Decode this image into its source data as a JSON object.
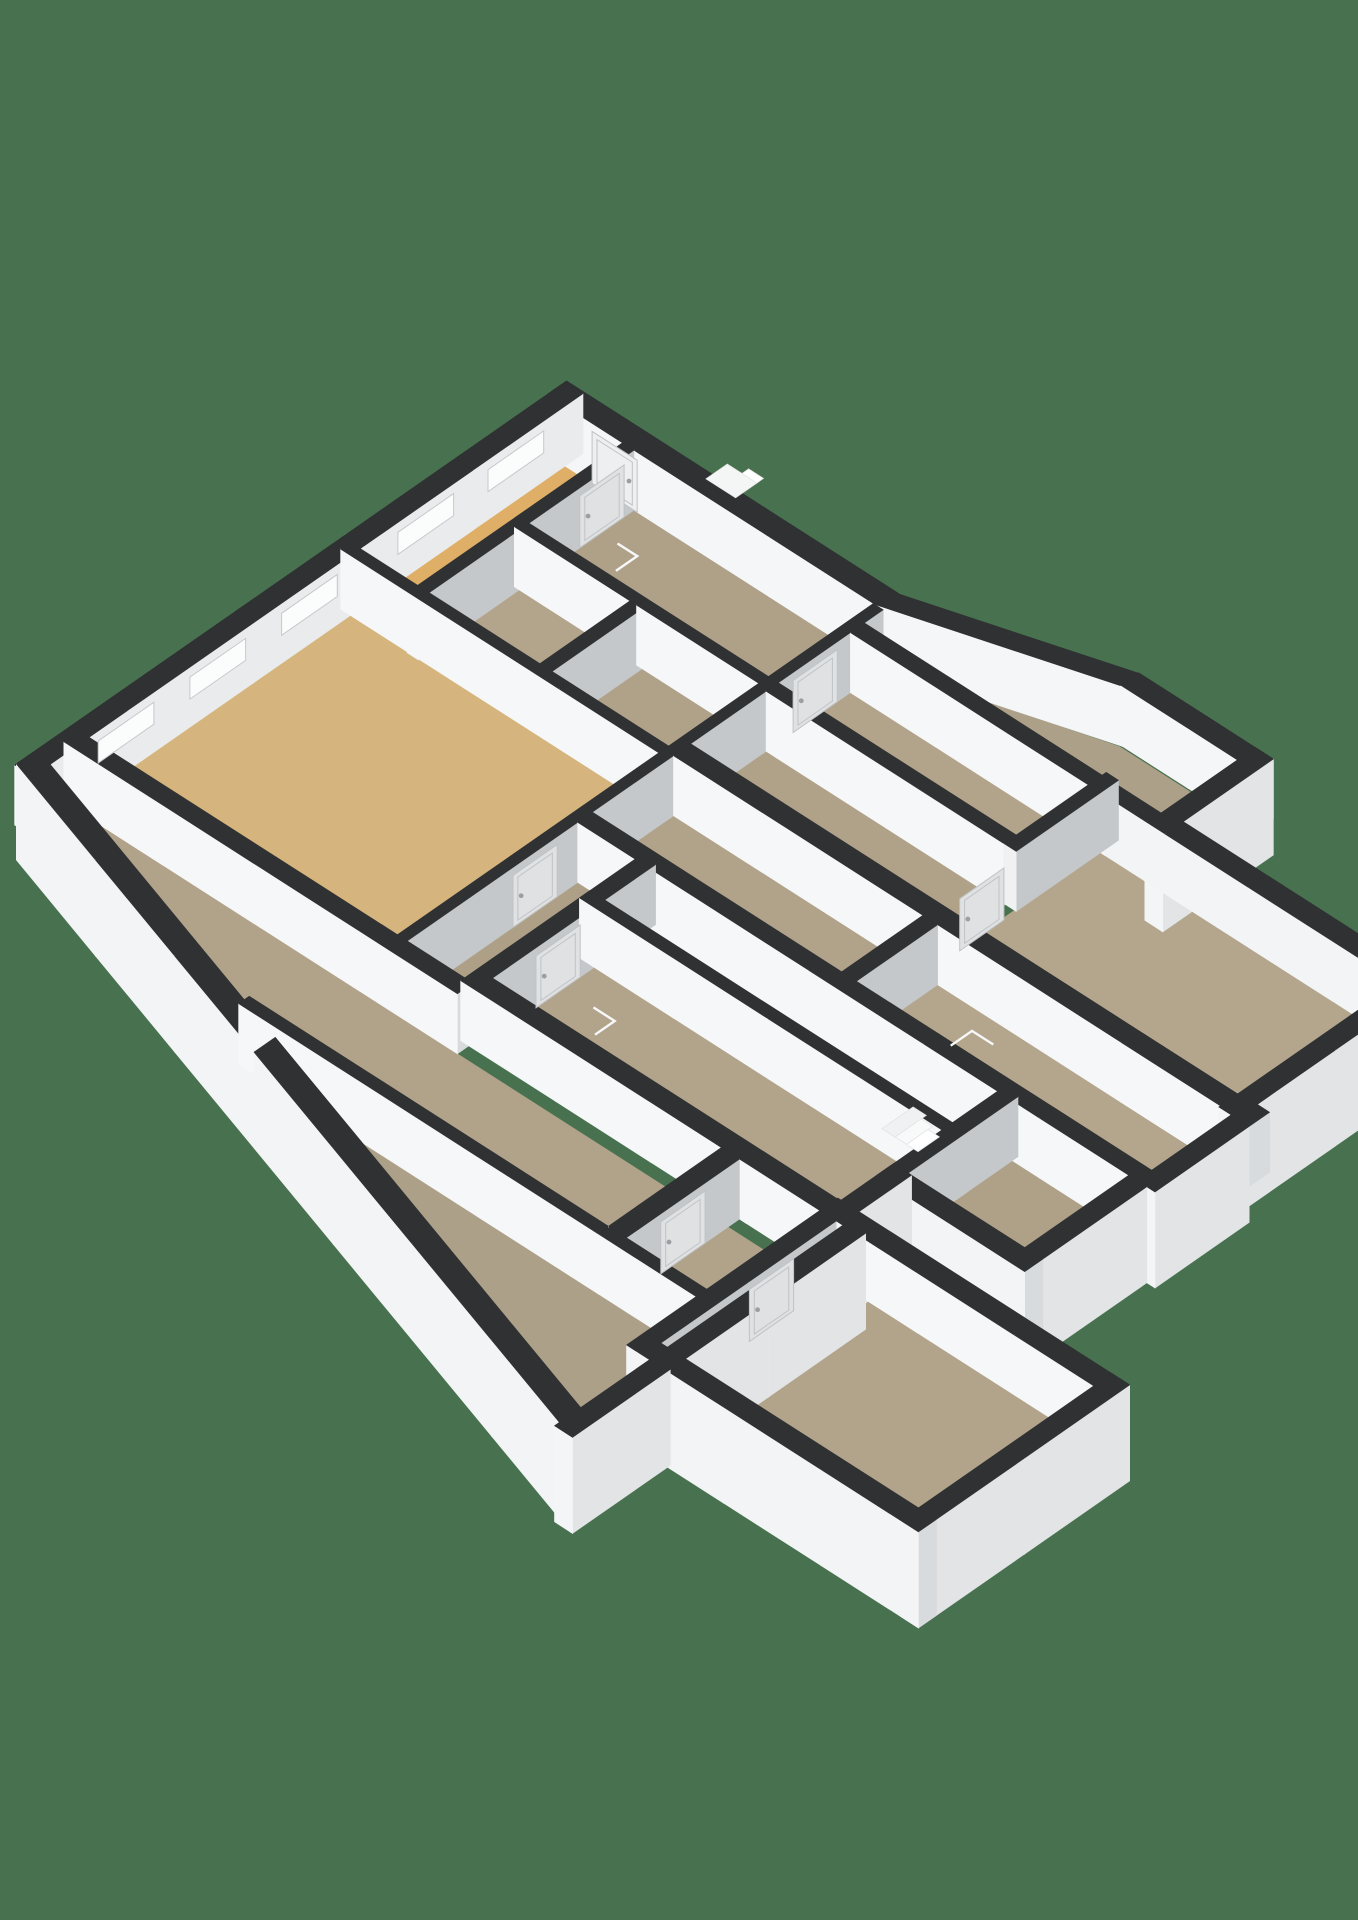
{
  "canvas": {
    "width": 1358,
    "height": 1920,
    "background": "#48714F"
  },
  "projection": {
    "ox": 565,
    "oy": 442,
    "exx": 0.82,
    "exy": 0.525,
    "eyx": -0.819,
    "eyy": 0.57,
    "wall_height": 60,
    "skirt_depth": 36,
    "chunk": 150
  },
  "palette": {
    "wall_top": "#2F3133",
    "face_white": "#F6F7F8",
    "face_gray": "#C4C8CB",
    "face_nw_inner": "#E9EBEC",
    "face_ext_east": "#E2E4E6",
    "face_ext_south": "#F3F4F5",
    "face_cap_gray": "#D8DADC",
    "skirt": "#C9CCCE",
    "floor_gold_big": "#D5B57D",
    "floor_gold_corridor": "#E2AC62",
    "floor_gold_hall": "#DFAF68",
    "floor_taupe": "#B1A28A",
    "window_fill": "#FBFCFC",
    "window_stroke": "#C6C9CB",
    "door_fill": "#DFE1E3",
    "door_stroke": "#C0C3C6",
    "door_fill_light": "#EDEFF0",
    "marker_white": "#F7F8F8"
  },
  "wall_types": {
    "extNW": {
      "fu": "#E9EBEC",
      "fv": "#F6F7F8",
      "skirt": false
    },
    "extTop": {
      "fu": "#DFE2E4",
      "fv": "#F5F6F7",
      "skirt": false
    },
    "extE": {
      "fu": "#E2E4E6",
      "fv": "#F4F5F6",
      "skirt": true
    },
    "extS": {
      "fu": "#D8DBDD",
      "fv": "#F3F4F5",
      "skirt": true
    },
    "extS_ns": {
      "fu": "#D8DBDD",
      "fv": "#F3F4F5",
      "skirt": false
    },
    "int_u": {
      "fu": "#D8DADC",
      "fv": "#F6F7F8",
      "skirt": false
    },
    "int_v": {
      "fu": "#C4C8CB",
      "fv": "#EFF1F2",
      "skirt": false
    }
  },
  "floors": [
    {
      "name": "floor-hall-nw",
      "color": "#DFAF68",
      "rect": [
        22,
        22,
        92,
        285
      ]
    },
    {
      "name": "floor-room-top",
      "color": "#AFA088",
      "rect": [
        100,
        22,
        398,
        150
      ]
    },
    {
      "name": "floor-room-mid-a",
      "color": "#B3A48C",
      "rect": [
        100,
        162,
        241,
        272
      ]
    },
    {
      "name": "floor-room-mid-b",
      "color": "#B0A189",
      "rect": [
        250,
        162,
        398,
        272
      ]
    },
    {
      "name": "floor-room-big-gold",
      "color": "#D5B57D",
      "rect": [
        22,
        284,
        398,
        603
      ]
    },
    {
      "name": "floor-room-ne",
      "color": "#ADA089",
      "pts": [
        [
          410,
          18
        ],
        [
          630,
          -46
        ],
        [
          772,
          -46
        ],
        [
          772,
          47
        ],
        [
          410,
          47
        ]
      ]
    },
    {
      "name": "floor-room-ne-low",
      "color": "#B2A38B",
      "rect": [
        410,
        60,
        702,
        152
      ]
    },
    {
      "name": "floor-room-right-big",
      "color": "#B4A58D",
      "rect": [
        713,
        60,
        1077,
        257
      ]
    },
    {
      "name": "floor-room-center",
      "color": "#B0A189",
      "rect": [
        410,
        165,
        702,
        257
      ]
    },
    {
      "name": "floor-room-d1",
      "color": "#B1A28A",
      "rect": [
        410,
        278,
        714,
        377
      ]
    },
    {
      "name": "floor-room-d2",
      "color": "#B4A58D",
      "rect": [
        732,
        278,
        1092,
        377
      ]
    },
    {
      "name": "floor-room-d3",
      "color": "#AEA087",
      "rect": [
        410,
        388,
        480,
        587
      ]
    },
    {
      "name": "floor-corridor-gold",
      "color": "#E2AC62",
      "rect": [
        498,
        388,
        922,
        450
      ]
    },
    {
      "name": "floor-room-f1",
      "color": "#B2A38B",
      "rect": [
        498,
        463,
        922,
        587
      ]
    },
    {
      "name": "floor-room-f2",
      "color": "#AFA088",
      "rect": [
        940,
        395,
        1082,
        522
      ]
    },
    {
      "name": "floor-strip-s1",
      "color": "#B1A28A",
      "pts": [
        [
          22,
          622
        ],
        [
          946,
          622
        ],
        [
          946,
          746
        ],
        [
          333,
          746
        ],
        [
          22,
          651
        ]
      ]
    },
    {
      "name": "floor-strip-s2",
      "color": "#ADA089",
      "pts": [
        [
          388,
          759
        ],
        [
          946,
          759
        ],
        [
          946,
          920
        ],
        [
          920,
          920
        ]
      ]
    },
    {
      "name": "floor-wing",
      "color": "#B2A38B",
      "rect": [
        938,
        608,
        1252,
        822
      ]
    }
  ],
  "walls": [
    {
      "name": "wall-ext-nw",
      "type": "extNW",
      "rect": [
        0,
        0,
        22,
        672
      ],
      "windows": [
        [
          48,
          116
        ],
        [
          158,
          226
        ],
        [
          300,
          368
        ],
        [
          412,
          480
        ],
        [
          524,
          592
        ]
      ]
    },
    {
      "name": "wall-ext-ne-a",
      "type": "extTop",
      "rect": [
        0,
        -2,
        406,
        22
      ],
      "doors": [
        {
          "face": "v",
          "span": [
            55,
            110
          ],
          "style": "light"
        }
      ]
    },
    {
      "name": "wall-ext-ne-diag",
      "type": "extTop",
      "quad": [
        [
          400,
          0
        ],
        [
          632,
          -70
        ],
        [
          632,
          -48
        ],
        [
          400,
          22
        ]
      ]
    },
    {
      "name": "wall-ext-ne-b",
      "type": "extTop",
      "rect": [
        630,
        -70,
        794,
        -48
      ]
    },
    {
      "name": "wall-ext-ne-east",
      "type": "extE",
      "rect": [
        772,
        -70,
        794,
        65
      ]
    },
    {
      "name": "wall-ne-step-south",
      "type": "extS_ns",
      "rect": [
        720,
        45,
        794,
        62
      ]
    },
    {
      "name": "wall-room-right-north",
      "type": "extS_ns",
      "rect": [
        794,
        40,
        1099,
        62
      ]
    },
    {
      "name": "wall-int-t2-t3",
      "type": "int_u",
      "rect": [
        410,
        45,
        720,
        62
      ]
    },
    {
      "name": "wall-int-divider-ne",
      "type": "int_v",
      "rect": [
        700,
        40,
        715,
        165
      ],
      "doors": [
        {
          "face": "u",
          "span": [
            180,
            234
          ]
        }
      ]
    },
    {
      "name": "wall-ext-right-east",
      "type": "extE",
      "rect": [
        1077,
        40,
        1099,
        280
      ]
    },
    {
      "name": "wall-ext-right-step",
      "type": "extS_ns",
      "rect": [
        1077,
        255,
        1114,
        280
      ]
    },
    {
      "name": "wall-ext-d2-east",
      "type": "extE",
      "rect": [
        1092,
        280,
        1114,
        395
      ]
    },
    {
      "name": "wall-int-row2",
      "type": "int_u",
      "rect": [
        410,
        150,
        702,
        165
      ]
    },
    {
      "name": "wall-int-row3",
      "type": "int_u",
      "rect": [
        410,
        257,
        1092,
        278
      ]
    },
    {
      "name": "wall-spine",
      "type": "int_v",
      "rect": [
        398,
        22,
        410,
        608
      ],
      "doors": [
        {
          "face": "u",
          "span": [
            78,
            132
          ]
        },
        {
          "face": "u",
          "span": [
            420,
            474
          ]
        }
      ]
    },
    {
      "name": "wall-int-d1-d2",
      "type": "int_v",
      "rect": [
        714,
        278,
        732,
        377
      ]
    },
    {
      "name": "wall-int-row4",
      "type": "int_u",
      "rect": [
        410,
        377,
        1114,
        395
      ]
    },
    {
      "name": "wall-int-d3",
      "type": "int_v",
      "rect": [
        480,
        388,
        498,
        587
      ],
      "doors": [
        {
          "face": "u",
          "span": [
            480,
            534
          ]
        }
      ]
    },
    {
      "name": "wall-int-corridor-south",
      "type": "int_u",
      "rect": [
        480,
        450,
        940,
        463
      ]
    },
    {
      "name": "wall-int-corridor-east",
      "type": "int_v",
      "rect": [
        922,
        388,
        940,
        522
      ]
    },
    {
      "name": "wall-ext-f2-south",
      "type": "extS",
      "rect": [
        922,
        522,
        1104,
        544
      ]
    },
    {
      "name": "wall-ext-f2-east",
      "type": "extE",
      "rect": [
        1082,
        395,
        1104,
        544
      ]
    },
    {
      "name": "wall-int-f1-south",
      "type": "int_u",
      "rect": [
        480,
        587,
        944,
        608
      ]
    },
    {
      "name": "wall-int-g1-south",
      "type": "int_u",
      "rect": [
        10,
        603,
        490,
        622
      ]
    },
    {
      "name": "wall-stub-s1",
      "type": "int_v",
      "rect": [
        798,
        608,
        820,
        746
      ],
      "doors": [
        {
          "face": "u",
          "span": [
            650,
            704
          ]
        }
      ]
    },
    {
      "name": "wall-int-s1-s2",
      "type": "int_u",
      "rect": [
        360,
        746,
        946,
        759
      ]
    },
    {
      "name": "wall-ext-strips-east",
      "type": "extE",
      "rect": [
        946,
        602,
        968,
        960
      ]
    },
    {
      "name": "wall-ext-notch",
      "type": "extE",
      "rect": [
        922,
        522,
        944,
        608
      ]
    },
    {
      "name": "wall-ext-sw-diagonal",
      "type": "extS",
      "quad": [
        [
          0,
          644
        ],
        [
          966,
          934
        ],
        [
          966,
          960
        ],
        [
          0,
          670
        ]
      ]
    },
    {
      "name": "wall-wing-north",
      "type": "int_u",
      "rect": [
        918,
        586,
        1274,
        608
      ]
    },
    {
      "name": "wall-wing-west",
      "type": "int_v",
      "rect": [
        918,
        608,
        938,
        822
      ],
      "doors": [
        {
          "face": "u",
          "span": [
            660,
            714
          ]
        }
      ]
    },
    {
      "name": "wall-wing-east",
      "type": "extE",
      "rect": [
        1252,
        586,
        1274,
        844
      ]
    },
    {
      "name": "wall-wing-south",
      "type": "extS",
      "rect": [
        918,
        822,
        1274,
        844
      ]
    },
    {
      "name": "wall-int-hall",
      "type": "int_v",
      "rect": [
        92,
        22,
        106,
        285
      ],
      "doors": [
        {
          "face": "u",
          "span": [
            34,
            88
          ]
        }
      ]
    },
    {
      "name": "wall-int-t1-south",
      "type": "int_u",
      "rect": [
        100,
        150,
        398,
        162
      ]
    },
    {
      "name": "wall-int-mid-div",
      "type": "int_v",
      "rect": [
        241,
        162,
        256,
        272
      ]
    },
    {
      "name": "wall-int-g1-north",
      "type": "int_u",
      "rect": [
        10,
        272,
        410,
        284
      ]
    }
  ],
  "markers": {
    "stair_steps": [
      {
        "name": "stair-step-1",
        "pts": [
          [
            828,
            404
          ],
          [
            844,
            404
          ],
          [
            844,
            442
          ],
          [
            828,
            442
          ]
        ],
        "color": "#F0F1F2"
      },
      {
        "name": "stair-step-2",
        "pts": [
          [
            844,
            410
          ],
          [
            858,
            410
          ],
          [
            858,
            442
          ],
          [
            844,
            442
          ]
        ],
        "color": "#F8F9F9"
      },
      {
        "name": "stair-step-3",
        "pts": [
          [
            858,
            416
          ],
          [
            872,
            416
          ],
          [
            872,
            442
          ],
          [
            858,
            442
          ]
        ],
        "color": "#FFFFFF"
      }
    ],
    "exterior_step": [
      {
        "name": "exterior-entry-step",
        "pts": [
          [
            178,
            -20
          ],
          [
            214,
            -20
          ],
          [
            214,
            6
          ],
          [
            178,
            6
          ]
        ],
        "z": 60,
        "color": "#F4F5F5"
      },
      {
        "name": "exterior-entry-step-upper",
        "pts": [
          [
            196,
            -28
          ],
          [
            214,
            -28
          ],
          [
            214,
            -20
          ],
          [
            196,
            -20
          ]
        ],
        "z": 60,
        "color": "#FFFFFF"
      }
    ],
    "swing_marks": [
      {
        "name": "door-swing-room-top",
        "u": 150,
        "v": 62,
        "du": -24,
        "dv": 26
      },
      {
        "name": "door-swing-room-d2",
        "u": 796,
        "v": 300,
        "du": 26,
        "dv": 26
      },
      {
        "name": "door-swing-room-f1",
        "u": 560,
        "v": 500,
        "du": -26,
        "dv": 24
      }
    ]
  }
}
